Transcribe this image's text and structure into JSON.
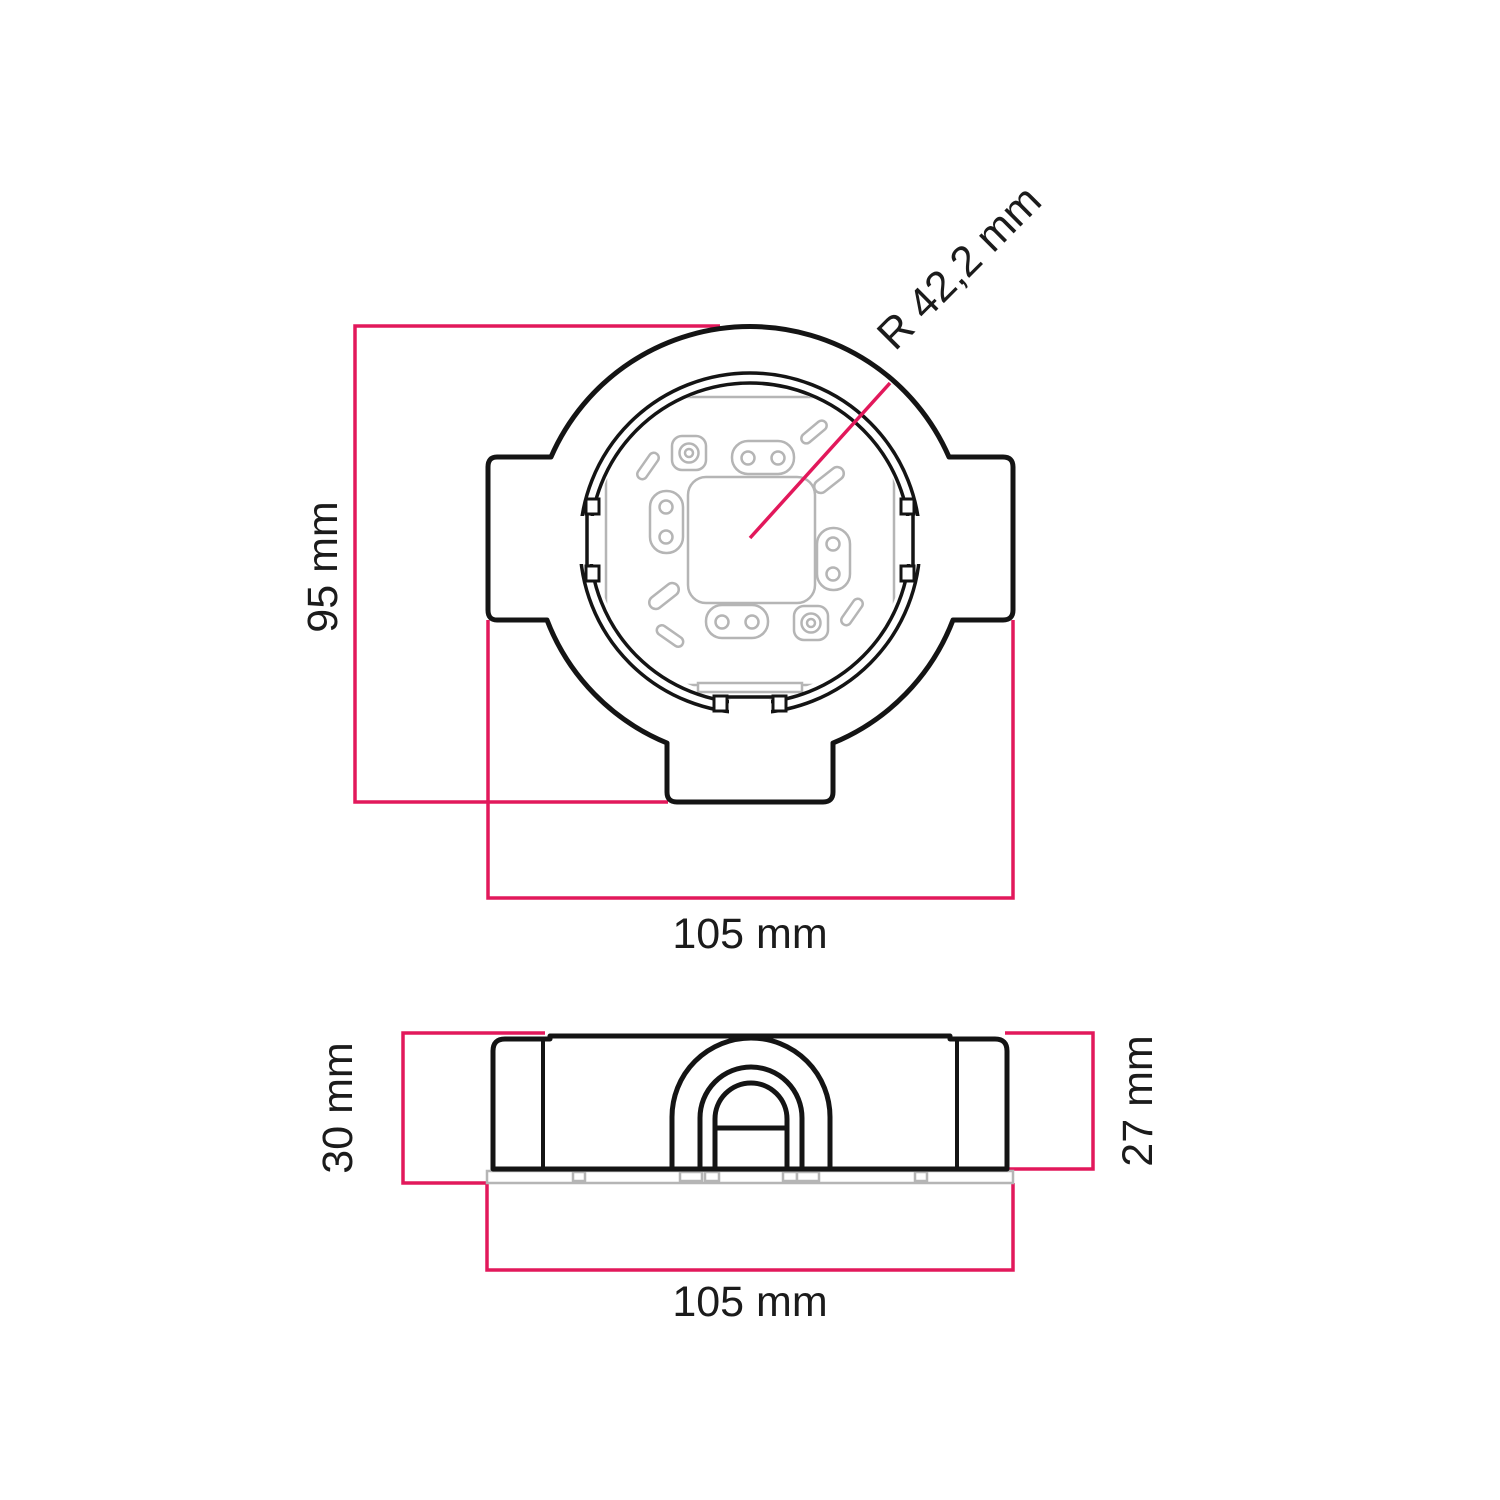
{
  "colors": {
    "dimension": "#e2185b",
    "outline": "#141414",
    "detail": "#b5b5b5",
    "background": "#ffffff",
    "text": "#1b1b1b"
  },
  "views": {
    "top": {
      "dim_height": "95 mm",
      "dim_width": "105 mm",
      "dim_radius": "R 42,2 mm"
    },
    "side": {
      "dim_total_height": "30 mm",
      "dim_body_height": "27 mm",
      "dim_width": "105 mm"
    }
  }
}
